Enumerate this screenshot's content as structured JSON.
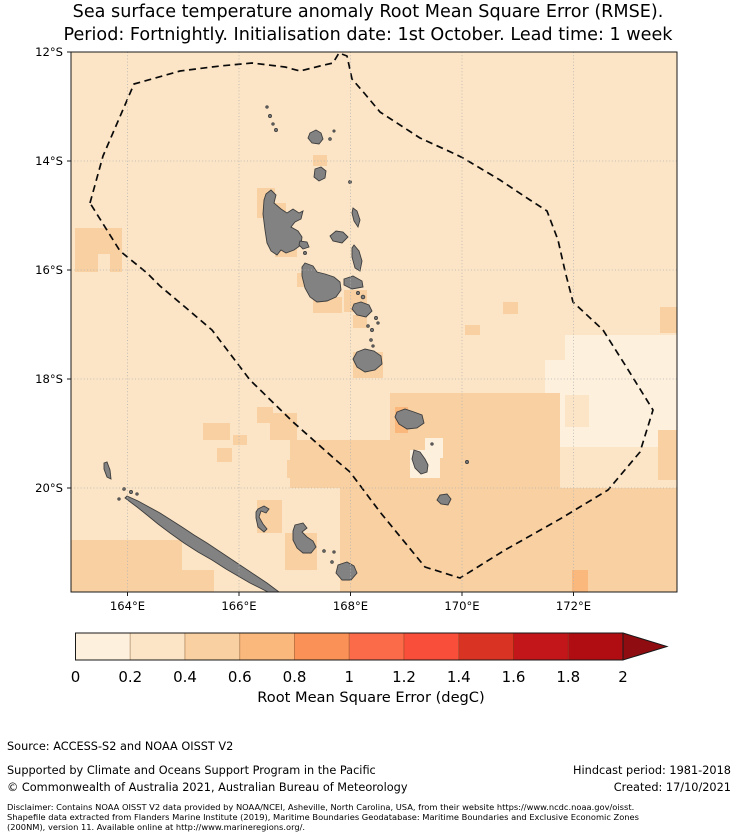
{
  "title": {
    "line1": "Sea surface temperature anomaly Root Mean Square Error (RMSE).",
    "line2": "Period: Fortnightly. Initialisation date: 1st October. Lead time: 1 week"
  },
  "map": {
    "lat_ticks": [
      "12°S",
      "14°S",
      "16°S",
      "18°S",
      "20°S"
    ],
    "lon_ticks": [
      "164°E",
      "166°E",
      "168°E",
      "170°E",
      "172°E"
    ],
    "land_color": "#828282",
    "boundary_color": "#0a0a0a",
    "boundary_meaning": "Exclusive Economic Zone (dashed)"
  },
  "colorbar": {
    "label": "Root Mean Square Error (degC)",
    "ticks": [
      "0",
      "0.2",
      "0.4",
      "0.6",
      "0.8",
      "1",
      "1.2",
      "1.4",
      "1.6",
      "1.8",
      "2"
    ],
    "colors": [
      "#fdf0dd",
      "#fce5c6",
      "#f8d0a2",
      "#fbb87c",
      "#fa9156",
      "#fb6b4a",
      "#f94f3a",
      "#d93423",
      "#c3161b",
      "#b00d13"
    ],
    "arrow_color": "#8f0c11"
  },
  "footer": {
    "source": "Source: ACCESS-S2 and NOAA OISST V2",
    "supported": "Supported by Climate and Oceans Support Program in the Pacific",
    "copyright": "© Commonwealth of Australia 2021, Australian Bureau of Meteorology",
    "hindcast": "Hindcast period: 1981-2018",
    "created": "Created: 17/10/2021",
    "disclaimer_line1": "Disclaimer: Contains NOAA OISST V2 data provided by NOAA/NCEI, Asheville, North Carolina, USA, from their website https://www.ncdc.noaa.gov/oisst.",
    "disclaimer_line2": "Shapefile data extracted from Flanders Marine Institute (2019), Maritime Boundaries Geodatabase: Maritime Boundaries and Exclusive Economic Zones",
    "disclaimer_line3": "(200NM), version 11. Available online at http://www.marineregions.org/."
  },
  "chart_data": {
    "type": "heatmap",
    "title": "Sea surface temperature anomaly Root Mean Square Error (RMSE). Period: Fortnightly. Initialisation date: 1st October. Lead time: 1 week",
    "x_axis": {
      "label_ticks": [
        "164°E",
        "166°E",
        "168°E",
        "170°E",
        "172°E"
      ],
      "range_deg_east": [
        163.0,
        173.9
      ]
    },
    "y_axis": {
      "label_ticks": [
        "12°S",
        "14°S",
        "16°S",
        "18°S",
        "20°S"
      ],
      "range_deg_south": [
        12.0,
        21.9
      ]
    },
    "colorbar": {
      "label": "Root Mean Square Error (degC)",
      "range": [
        0,
        2
      ],
      "step": 0.2,
      "extend": "max"
    },
    "value_summary": "Most ocean cells are 0.2-0.4 degC (light peach). Patches of 0.4-0.6 degC occur around the Vanuatu islands, west of the EEZ near 16°S, southeast of the boundary and across the area south of 20°S. Isolated 0.6-0.8 degC cells sit beside Erromango (~168.8°E, 18.9°S) and near 172.1°E, 21.5°S. Lightest 0-0.2 degC cells lie east of Tanna and in the eastern EEZ lobe around 171-173°E, 17-19.5°S.",
    "cells_px_palette_idx": [
      [
        545,
        335,
        132,
        112,
        0
      ],
      [
        545,
        335,
        20,
        25,
        1
      ],
      [
        565,
        395,
        24,
        32,
        1
      ],
      [
        658,
        430,
        19,
        50,
        2
      ],
      [
        390,
        393,
        170,
        95,
        2
      ],
      [
        425,
        438,
        18,
        20,
        0
      ],
      [
        410,
        450,
        30,
        28,
        0
      ],
      [
        290,
        440,
        105,
        48,
        2
      ],
      [
        340,
        488,
        337,
        104,
        2
      ],
      [
        70,
        540,
        112,
        52,
        2
      ],
      [
        150,
        540,
        32,
        32,
        2
      ],
      [
        176,
        570,
        38,
        22,
        2
      ],
      [
        257,
        500,
        25,
        33,
        2
      ],
      [
        285,
        533,
        32,
        37,
        2
      ],
      [
        313,
        155,
        14,
        11,
        2
      ],
      [
        257,
        188,
        18,
        30,
        2
      ],
      [
        275,
        203,
        11,
        14,
        2
      ],
      [
        75,
        228,
        47,
        26,
        2
      ],
      [
        75,
        254,
        23,
        18,
        2
      ],
      [
        110,
        254,
        12,
        18,
        2
      ],
      [
        275,
        245,
        22,
        12,
        2
      ],
      [
        297,
        273,
        11,
        14,
        2
      ],
      [
        313,
        297,
        29,
        16,
        2
      ],
      [
        344,
        290,
        23,
        22,
        2
      ],
      [
        353,
        315,
        14,
        13,
        2
      ],
      [
        353,
        352,
        30,
        26,
        2
      ],
      [
        203,
        423,
        27,
        17,
        2
      ],
      [
        233,
        435,
        14,
        10,
        2
      ],
      [
        217,
        448,
        15,
        14,
        2
      ],
      [
        257,
        407,
        16,
        16,
        2
      ],
      [
        270,
        413,
        27,
        27,
        2
      ],
      [
        287,
        460,
        16,
        18,
        2
      ],
      [
        660,
        307,
        17,
        26,
        2
      ],
      [
        503,
        302,
        15,
        12,
        2
      ],
      [
        465,
        325,
        15,
        10,
        2
      ],
      [
        395,
        407,
        13,
        26,
        3
      ],
      [
        572,
        570,
        16,
        22,
        3
      ]
    ]
  }
}
